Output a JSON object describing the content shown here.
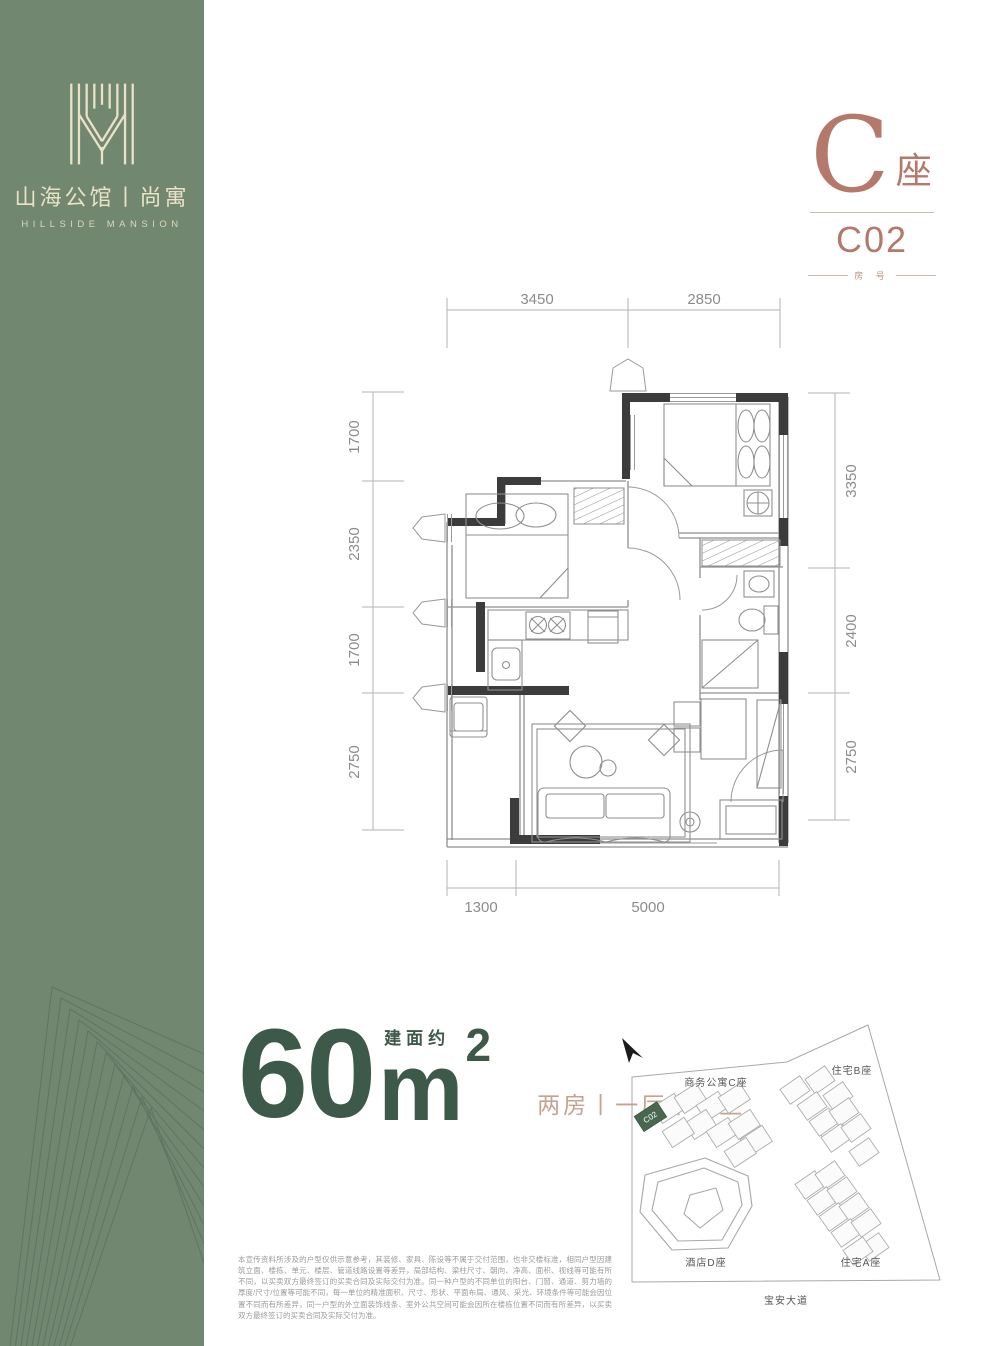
{
  "brand": {
    "name_cn": "山海公馆丨尚寓",
    "name_en": "HILLSIDE MANSION"
  },
  "unit": {
    "building_letter": "C",
    "building_suffix": "座",
    "unit_code": "C02",
    "unit_code_label": "房 号"
  },
  "area": {
    "value": "60",
    "unit_letter": "m",
    "unit_sup": "2",
    "prefix": "建面约",
    "layout": "两房丨一厅丨一卫"
  },
  "dimensions": {
    "top": [
      "3450",
      "2850"
    ],
    "left": [
      "1700",
      "2350",
      "1700",
      "2750"
    ],
    "right": [
      "3350",
      "2400",
      "2750"
    ],
    "bottom": [
      "1300",
      "5000"
    ]
  },
  "sitemap": {
    "labels": {
      "apartment_c": "商务公寓C座",
      "residence_b": "住宅B座",
      "hotel_d": "酒店D座",
      "residence_a": "住宅A座",
      "road": "宝安大道",
      "highlight_unit": "C02"
    }
  },
  "disclaimer": "本宣传资料所涉及的户型仅供示意参考，其装修、家具、陈设等不属于交付范围，也非交楼标准，相同户型因建筑立面、楼栋、单元、楼层、管道线路设置等差异，局部结构、梁柱尺寸、朝向、净高、面积、视线等可能有所不同，以买卖双方最终签订的买卖合同及实际交付为准。同一种户型的不同单位的阳台、门窗、通道、剪力墙的厚度/尺寸/位置等可能不同，每一单位的精准面积、尺寸、形状、平面布局、通风、采光、环境条件等可能会因位置不同而有所差异，同一户型的外立面装饰线条、室外公共空间可能会因所在楼栋位置不同而有所差异，以买卖双方最终签订的买卖合同及实际交付为准。",
  "colors": {
    "sidebar_green": "#718770",
    "logo_cream": "#e9e2c8",
    "accent_rose": "#b5796b",
    "area_green": "#3d594a",
    "layout_rose": "#c7a192",
    "highlight_building": "#47684f"
  }
}
